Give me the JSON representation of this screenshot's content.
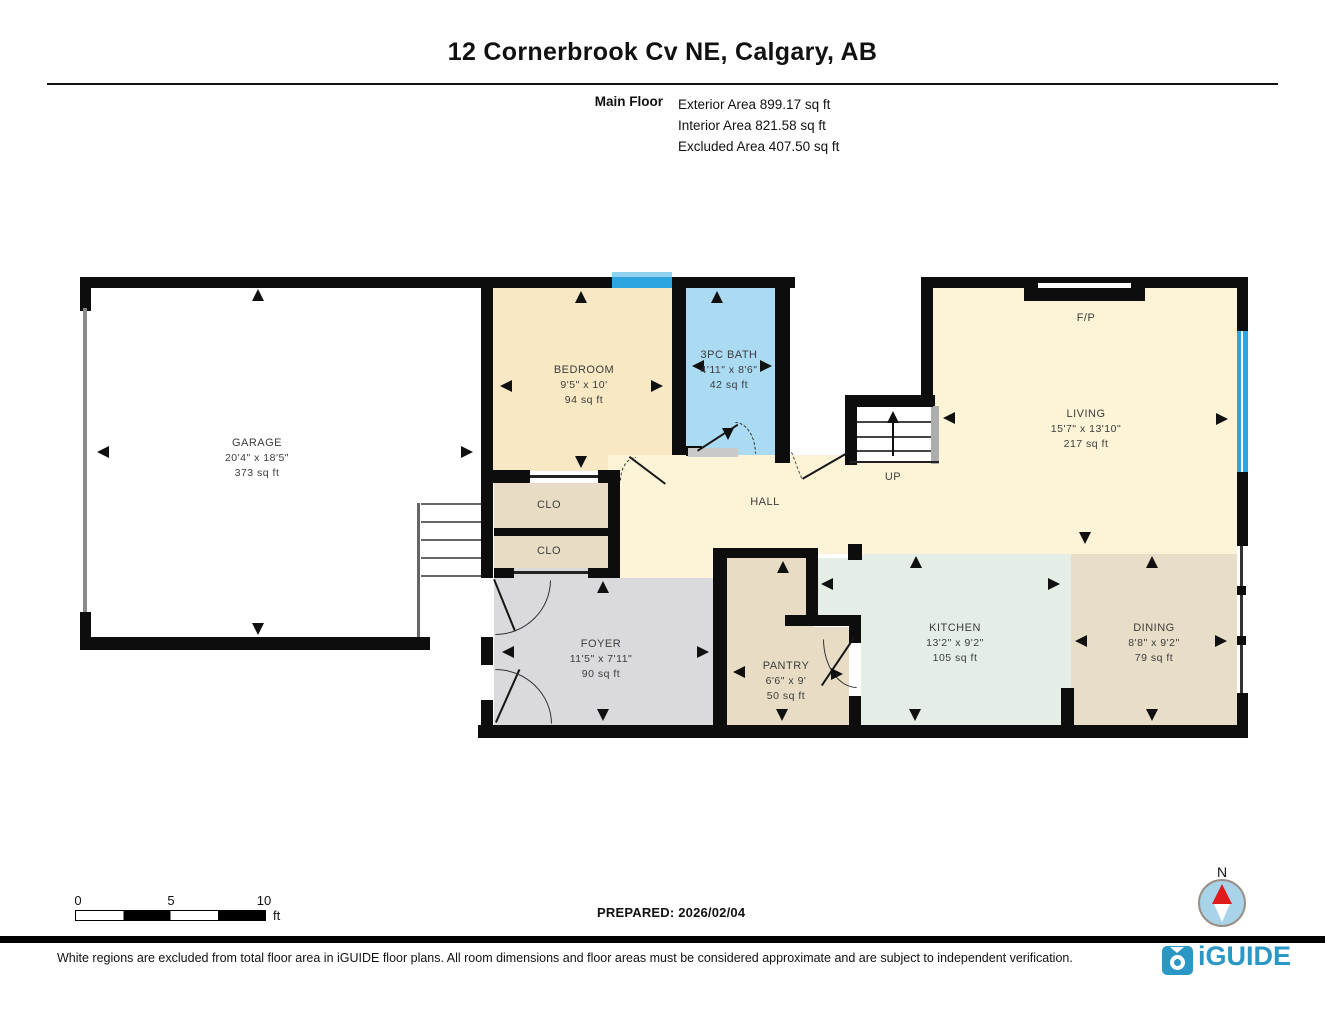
{
  "header": {
    "title": "12 Cornerbrook Cv NE, Calgary, AB",
    "floor_label": "Main Floor",
    "area_lines": [
      "Exterior Area 899.17 sq ft",
      "Interior Area 821.58 sq ft",
      "Excluded Area 407.50 sq ft"
    ]
  },
  "rooms": {
    "garage": {
      "name": "GARAGE",
      "dims": "20'4\" x 18'5\"",
      "area": "373 sq ft"
    },
    "bedroom": {
      "name": "BEDROOM",
      "dims": "9'5\" x 10'",
      "area": "94 sq ft"
    },
    "bath": {
      "name": "3PC BATH",
      "dims": "4'11\" x 8'6\"",
      "area": "42 sq ft"
    },
    "living": {
      "name": "LIVING",
      "dims": "15'7\" x 13'10\"",
      "area": "217 sq ft"
    },
    "hall": {
      "name": "HALL"
    },
    "clo1": {
      "name": "CLO"
    },
    "clo2": {
      "name": "CLO"
    },
    "foyer": {
      "name": "FOYER",
      "dims": "11'5\" x 7'11\"",
      "area": "90 sq ft"
    },
    "pantry": {
      "name": "PANTRY",
      "dims": "6'6\" x 9'",
      "area": "50 sq ft"
    },
    "kitchen": {
      "name": "KITCHEN",
      "dims": "13'2\" x 9'2\"",
      "area": "105 sq ft"
    },
    "dining": {
      "name": "DINING",
      "dims": "8'8\" x 9'2\"",
      "area": "79 sq ft"
    },
    "fireplace": {
      "name": "F/P"
    },
    "stairs": {
      "name": "UP"
    }
  },
  "scale_bar": {
    "labels": [
      "0",
      "5",
      "10"
    ],
    "unit": "ft"
  },
  "compass": {
    "north_label": "N"
  },
  "footer": {
    "prepared": "PREPARED: 2026/02/04",
    "disclaimer": "White regions are excluded from total floor area in iGUIDE floor plans. All room dimensions and floor areas must be considered approximate and are subject to independent verification.",
    "brand": "iGUIDE"
  },
  "colors": {
    "wall": "#0d0d0d",
    "room_cream": "#fdf3d6",
    "bedroom_cream": "#f8e8c3",
    "bath_blue": "#abdaf3",
    "window_blue": "#2da4dd",
    "closet_tan": "#e8ddc4",
    "dining_tan": "#e8dec8",
    "kitchen_mint": "#e4eee6",
    "foyer_gray": "#dadadc",
    "brand_blue": "#2a97c5",
    "compass_red": "#e01b1b"
  }
}
